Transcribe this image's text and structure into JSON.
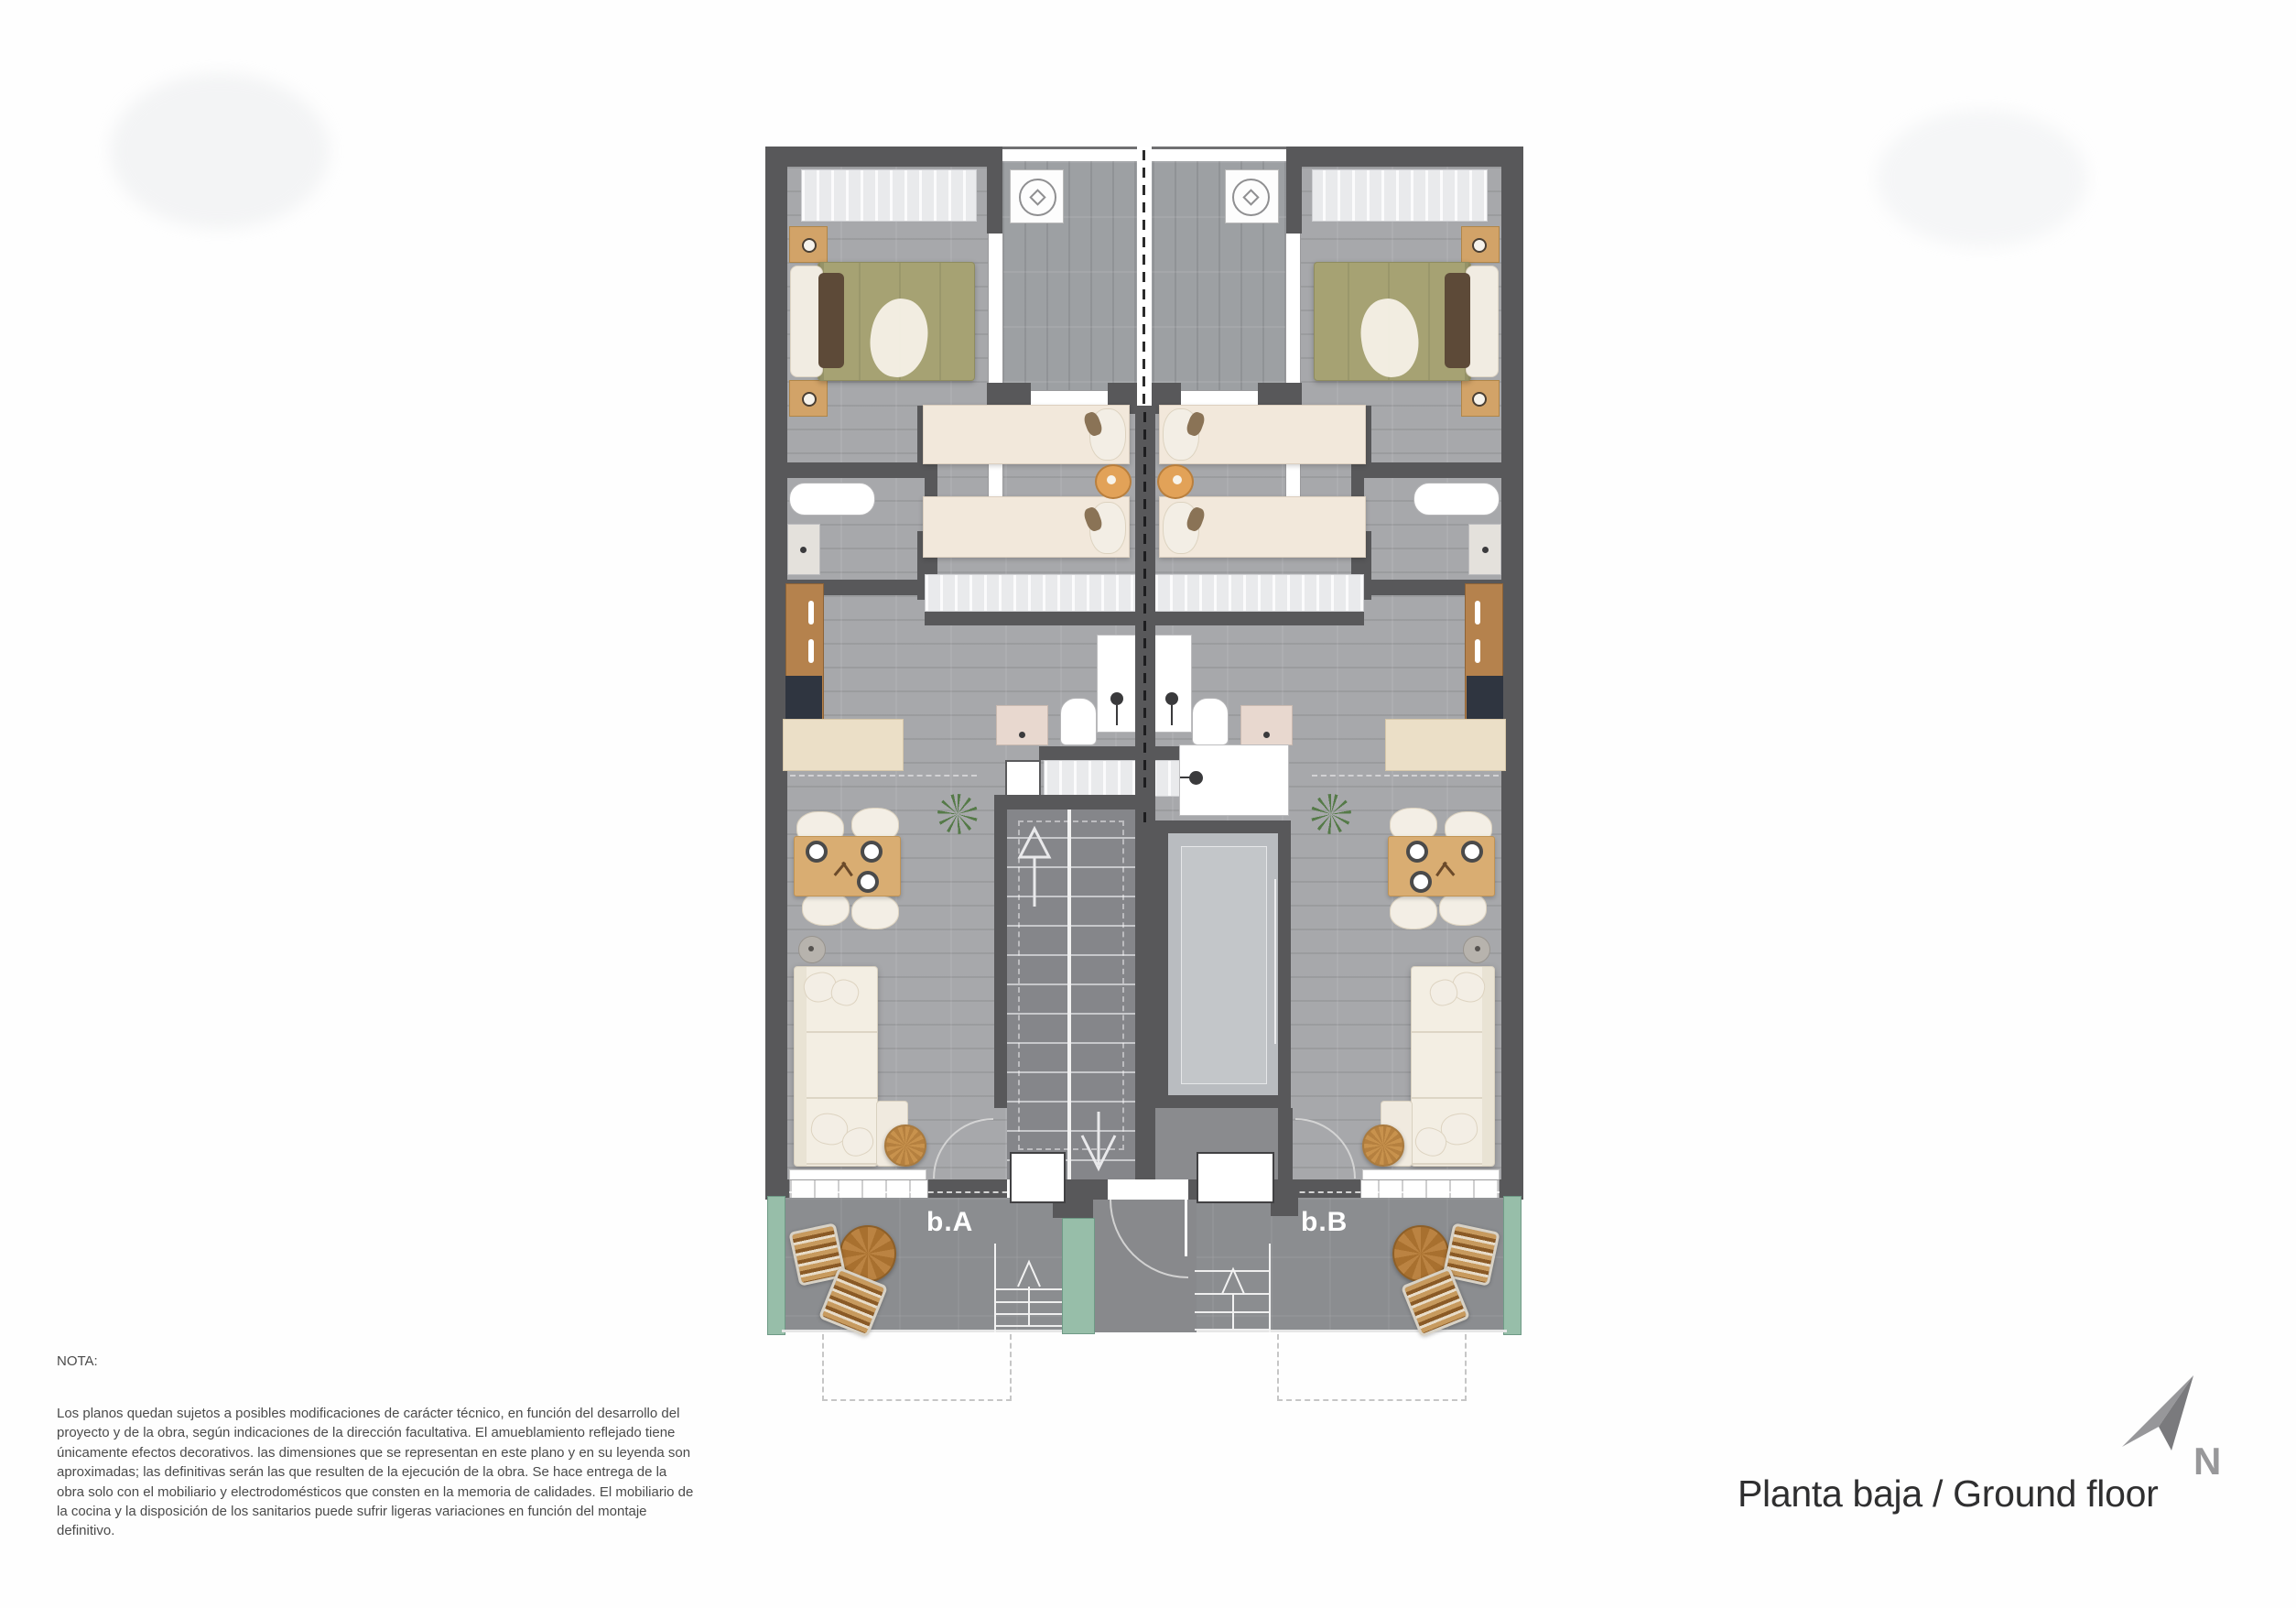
{
  "plan": {
    "unit_labels": {
      "a": "b.A",
      "b": "b.B"
    }
  },
  "note": {
    "heading": "NOTA:",
    "text": "Los planos quedan sujetos a posibles modificaciones de carácter técnico, en función del desarrollo del proyecto y de la obra, según indicaciones de la dirección facultativa. El amueblamiento reflejado tiene únicamente efectos decorativos. las dimensiones que se representan en este plano y en su leyenda son aproximadas; las definitivas serán las que resulten de la ejecución de la obra. Se hace entrega de la obra solo con el mobiliario y electrodomésticos que consten en la memoria de calidades. El mobiliario de la cocina y la disposición de los sanitarios puede sufrir ligeras variaciones en función del montaje definitivo."
  },
  "footer": {
    "title": "Planta baja / Ground floor",
    "compass_label": "N"
  },
  "palette": {
    "wall": "#58585a",
    "floor": "#a7a8ab",
    "terrace": "#8b8d90",
    "planter_teal": "#97bea9",
    "bed_olive": "#a6a273",
    "furniture_cream": "#f2e8db",
    "wood": "#b5824d",
    "plant_green": "#557a48"
  }
}
